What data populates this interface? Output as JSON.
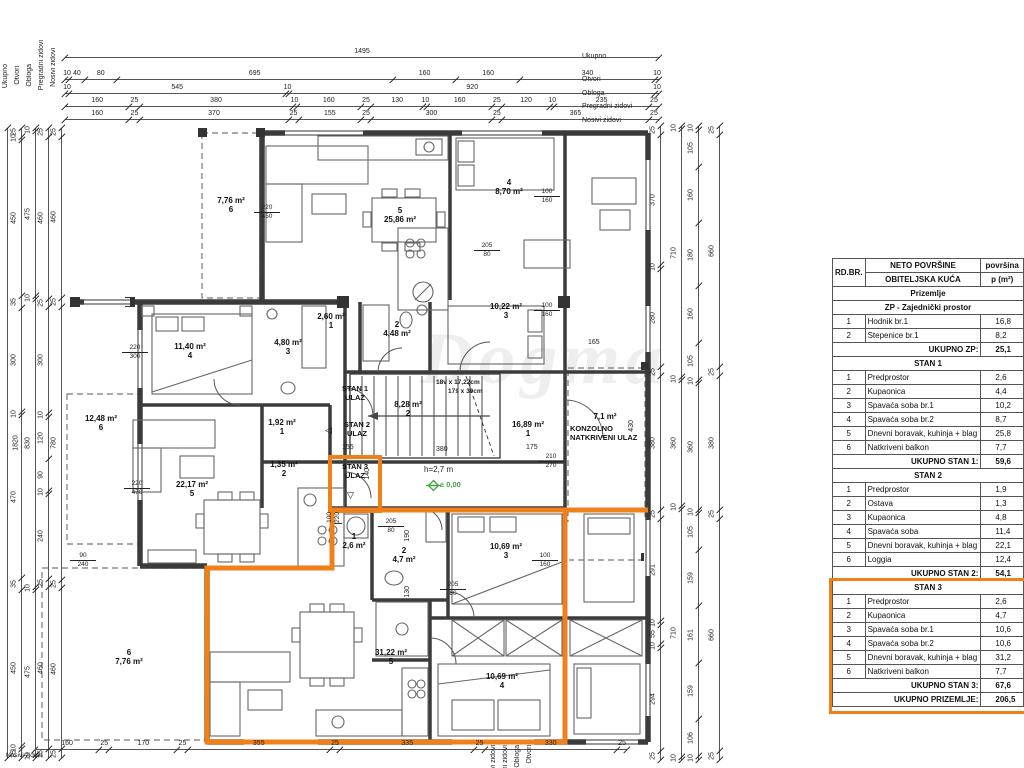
{
  "watermark": {
    "text": "Dogma"
  },
  "colors": {
    "accent_orange": "#F08019",
    "level_green": "#3FA33F",
    "wall": "#3B3B3B"
  },
  "legend": {
    "left_labels": [
      "Ukupno",
      "Otvori",
      "Obloga",
      "Pregradni zidovi",
      "Nosivi zidovi"
    ],
    "right_labels": [
      "Ukupno",
      "Otvori",
      "Obloga",
      "Pregradni zidovi",
      "Nosivi zidovi"
    ],
    "bottom_labels": [
      "Nosivi zidovi",
      "Pregradni zidovi",
      "Obloga",
      "Otvori"
    ],
    "bottom_left_label": "Nosivi zidovi"
  },
  "dims": {
    "top_ukupno": [
      "1495"
    ],
    "top_otvori": [
      "10",
      "40",
      "80",
      "695",
      "160",
      "160",
      "340",
      "10"
    ],
    "top_obloga": [
      "10",
      "545",
      "10",
      "920",
      "10"
    ],
    "top_pregradni": [
      "160",
      "25",
      "380",
      "10",
      "160",
      "25",
      "130",
      "10",
      "160",
      "25",
      "120",
      "10",
      "235",
      "25"
    ],
    "top_nosivi": [
      "160",
      "25",
      "370",
      "25",
      "155",
      "25",
      "300",
      "25",
      "365",
      "25"
    ],
    "bottom": [
      "160",
      "25",
      "170",
      "25",
      "355",
      "25",
      "335",
      "25",
      "330",
      "25"
    ],
    "left_total": [
      "1820"
    ],
    "left_c1": [
      "25",
      "10",
      "450",
      "35",
      "300",
      "10",
      "470",
      "35",
      "450",
      "10",
      "25"
    ],
    "left_c2": [
      "10",
      "475",
      "10",
      "830",
      "10",
      "475",
      "10"
    ],
    "left_c3": [
      "25",
      "460",
      "25",
      "300",
      "10",
      "120",
      "90",
      "10",
      "240",
      "25",
      "460",
      "25"
    ],
    "left_c4": [
      "25",
      "460",
      "25",
      "780",
      "25",
      "460",
      "25"
    ],
    "right_c1": [
      "25",
      "370",
      "10",
      "280",
      "25",
      "380",
      "25",
      "291",
      "10",
      "55",
      "10",
      "294",
      "25"
    ],
    "right_c2": [
      "10",
      "710",
      "10",
      "360",
      "10",
      "710",
      "10"
    ],
    "right_c3": [
      "10",
      "105",
      "160",
      "180",
      "160",
      "105",
      "10",
      "360",
      "10",
      "105",
      "159",
      "161",
      "159",
      "106",
      "10"
    ],
    "right_c4": [
      "25",
      "660",
      "25",
      "380",
      "25",
      "660",
      "25"
    ],
    "inner": {
      "i165": "165",
      "i175": "175",
      "i380": "380",
      "i155": "155",
      "i430": "430",
      "i140": "140",
      "i190": "190",
      "i130": "130"
    }
  },
  "openings": [
    {
      "t": "220",
      "b": "450"
    },
    {
      "t": "220",
      "b": "300"
    },
    {
      "t": "100",
      "b": "160"
    },
    {
      "t": "205",
      "b": "80"
    },
    {
      "t": "100",
      "b": "160"
    },
    {
      "t": "220",
      "b": "470"
    },
    {
      "t": "90",
      "b": "240"
    },
    {
      "t": "205",
      "b": "80"
    },
    {
      "t": "100",
      "b": "160"
    },
    {
      "t": "210",
      "b": "270"
    },
    {
      "t": "100",
      "b": "220"
    },
    {
      "t": "205",
      "b": "80"
    }
  ],
  "rooms": [
    {
      "l1": "7,76 m²",
      "l2": "6"
    },
    {
      "l1": "5",
      "l2": "25,86 m²"
    },
    {
      "l1": "4",
      "l2": "8,70 m²"
    },
    {
      "l1": "11,40 m²",
      "l2": "4"
    },
    {
      "l1": "4,80 m²",
      "l2": "3"
    },
    {
      "l1": "2,60 m²",
      "l2": "1"
    },
    {
      "l1": "2",
      "l2": "4,48 m²"
    },
    {
      "l1": "10,22 m²",
      "l2": "3"
    },
    {
      "l1": "12,48 m²",
      "l2": "6"
    },
    {
      "l1": "22,17 m²",
      "l2": "5"
    },
    {
      "l1": "1,92 m²",
      "l2": "1"
    },
    {
      "l1": "1,35 m²",
      "l2": "2"
    },
    {
      "l1": "8,28 m²",
      "l2": "2"
    },
    {
      "l1": "16,89 m²",
      "l2": "1"
    },
    {
      "l1": "1",
      "l2": "2,6 m²"
    },
    {
      "l1": "2",
      "l2": "4,7 m²"
    },
    {
      "l1": "10,69 m²",
      "l2": "3"
    },
    {
      "l1": "10,69 m²",
      "l2": "4"
    },
    {
      "l1": "31,22 m²",
      "l2": "5"
    },
    {
      "l1": "6",
      "l2": "7,76 m²"
    }
  ],
  "plan_texts": {
    "konzolno_area": "7,1 m²",
    "konzolno": "KONZOLNO NATKRIVENI ULAZ",
    "stairs_spec1": "18v x 17,22cm",
    "stairs_spec2": "17š x 30cm",
    "height": "h=2,7 m",
    "level": "± 0,00",
    "ulaz1": "STAN 1 ULAZ",
    "ulaz2": "STAN 2 ULAZ",
    "ulaz3": "STAN 3 ULAZ",
    "arrow_left": "◁",
    "arrow_down": "▽"
  },
  "table": {
    "header": {
      "col1": "RD.BR.",
      "col2a": "NETO POVRŠINE",
      "col2b": "OBITELJSKA KUĆA",
      "col3a": "površina",
      "col3b": "p (m²)"
    },
    "sections": [
      {
        "title": "Prizemlje",
        "rows": [],
        "total": null,
        "highlight": false
      },
      {
        "title": "ZP - Zajednički prostor",
        "rows": [
          [
            "1",
            "Hodnik br.1",
            "16,8"
          ],
          [
            "2",
            "Stepenice br.1",
            "8,2"
          ]
        ],
        "total": [
          "UKUPNO ZP:",
          "25,1"
        ],
        "highlight": false
      },
      {
        "title": "STAN 1",
        "rows": [
          [
            "1",
            "Predprostor",
            "2,6"
          ],
          [
            "2",
            "Kupaonica",
            "4,4"
          ],
          [
            "3",
            "Spavaća soba br.1",
            "10,2"
          ],
          [
            "4",
            "Spavaća soba br.2",
            "8,7"
          ],
          [
            "5",
            "Dnevni boravak, kuhinja + blag",
            "25,8"
          ],
          [
            "6",
            "Natkriveni balkon",
            "7,7"
          ]
        ],
        "total": [
          "UKUPNO STAN 1:",
          "59,6"
        ],
        "highlight": false
      },
      {
        "title": "STAN 2",
        "rows": [
          [
            "1",
            "Predprostor",
            "1,9"
          ],
          [
            "2",
            "Ostava",
            "1,3"
          ],
          [
            "3",
            "Kupaonica",
            "4,8"
          ],
          [
            "4",
            "Spavaća soba",
            "11,4"
          ],
          [
            "5",
            "Dnevni boravak, kuhinja + blag",
            "22,1"
          ],
          [
            "6",
            "Loggia",
            "12,4"
          ]
        ],
        "total": [
          "UKUPNO STAN 2:",
          "54,1"
        ],
        "highlight": false
      },
      {
        "title": "STAN 3",
        "rows": [
          [
            "1",
            "Predprostor",
            "2,6"
          ],
          [
            "2",
            "Kupaonica",
            "4,7"
          ],
          [
            "3",
            "Spavaća soba br.1",
            "10,6"
          ],
          [
            "4",
            "Spavaća soba br.2",
            "10,6"
          ],
          [
            "5",
            "Dnevni boravak, kuhinja + blag",
            "31,2"
          ],
          [
            "6",
            "Natkriveni balkon",
            "7,7"
          ]
        ],
        "total": [
          "UKUPNO STAN 3:",
          "67,6"
        ],
        "highlight": true
      },
      {
        "title": null,
        "rows": [],
        "total": [
          "UKUPNO PRIZEMLJE:",
          "206,5"
        ],
        "highlight": true
      }
    ]
  }
}
